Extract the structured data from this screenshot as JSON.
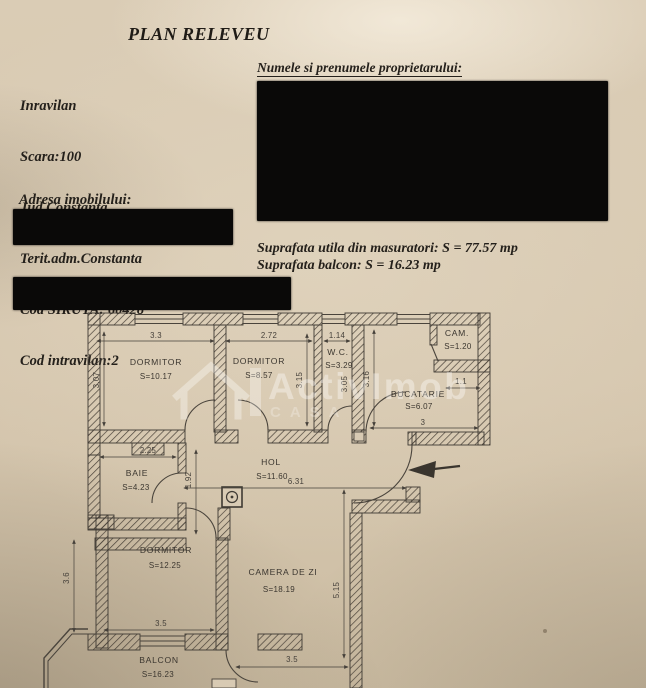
{
  "page": {
    "title": "PLAN RELEVEU"
  },
  "info_block": {
    "lines": [
      "Inravilan",
      "Scara:100",
      "Jud.Constanta",
      "Terit.adm.Constanta",
      "Cod SIRUTA: 60428",
      "Cod intravilan:2"
    ]
  },
  "owner_section": {
    "label": "Numele si prenumele proprietarului:"
  },
  "address_section": {
    "label": "Adresa imobilului:"
  },
  "measurements": {
    "usable_area": "Suprafata utila din masuratori: S = 77.57 mp",
    "balcony_area": "Suprafata balcon: S = 16.23 mp"
  },
  "watermark": {
    "brand": "ActivImob",
    "sub": "CASA"
  },
  "plan": {
    "rooms": [
      {
        "name": "DORMITOR",
        "area": "S=10.17"
      },
      {
        "name": "DORMITOR",
        "area": "S=8.57"
      },
      {
        "name": "W.C.",
        "area": "S=3.29"
      },
      {
        "name": "CAM.",
        "area": "S=1.20"
      },
      {
        "name": "BUCATARIE",
        "area": "S=6.07"
      },
      {
        "name": "BAIE",
        "area": "S=4.23"
      },
      {
        "name": "HOL",
        "area": "S=11.60"
      },
      {
        "name": "DORMITOR",
        "area": "S=12.25"
      },
      {
        "name": "CAMERA DE ZI",
        "area": "S=18.19"
      },
      {
        "name": "BALCON",
        "area": "S=16.23"
      }
    ],
    "dimensions": {
      "dorm1_w": "3.3",
      "dorm1_h": "3.07",
      "dorm2_w": "2.72",
      "dorm2_h": "3.15",
      "wc_w": "1.14",
      "wc_h": "3.05",
      "buc_h": "3.16",
      "buc_w": "3",
      "cam_w": "1.1",
      "baie_w": "2.25",
      "hol_h": "1.92",
      "hol_w": "6.31",
      "dorm3_h": "3.6",
      "dorm3_w": "3.5",
      "cdz_h": "5.15",
      "cdz_w": "3.5"
    }
  }
}
